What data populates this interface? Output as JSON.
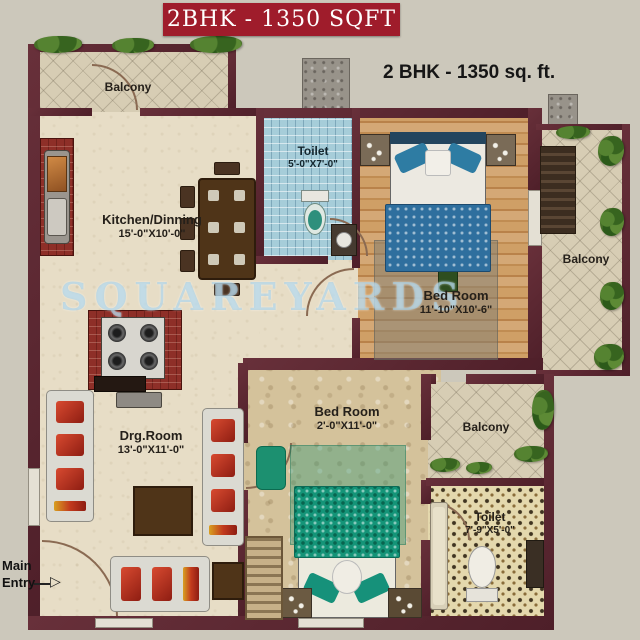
{
  "banner": {
    "title": "2BHK - 1350 SQFT"
  },
  "plan": {
    "heading": "2 BHK - 1350 sq. ft.",
    "watermark": "SQUAREYARDS",
    "rooms": {
      "balcony_top": {
        "label": "Balcony"
      },
      "kitchen": {
        "label": "Kitchen/Dinning",
        "size": "15'-0\"X10'-0\""
      },
      "toilet_top": {
        "label": "Toilet",
        "size": "5'-0\"X7'-0\""
      },
      "bedroom_top": {
        "label": "Bed Room",
        "size": "11'-10\"X10'-6\""
      },
      "balcony_right": {
        "label": "Balcony"
      },
      "drawing_room": {
        "label": "Drg.Room",
        "size": "13'-0\"X11'-0\""
      },
      "bedroom_bottom": {
        "label": "Bed Room",
        "size": "2'-0\"X11'-0\""
      },
      "balcony_bottom": {
        "label": "Balcony"
      },
      "toilet_bottom": {
        "label": "Toilet",
        "size": "7'-9\"X5'-0\""
      },
      "main_entry": {
        "line1": "Main",
        "line2": "Entry"
      }
    },
    "colors": {
      "wall": "#5a2530",
      "banner": "#9f1c2b"
    },
    "icons": {
      "entry_arrow": "▷"
    }
  }
}
